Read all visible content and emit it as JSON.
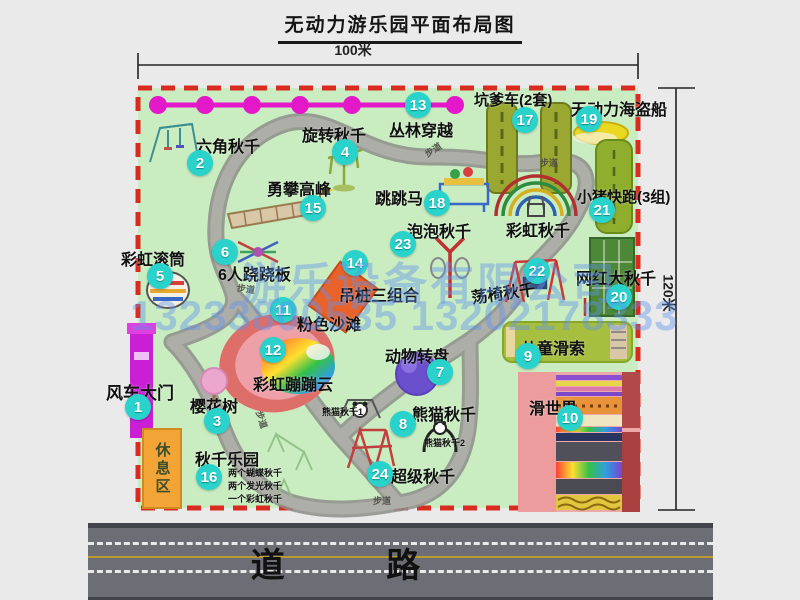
{
  "title": "无动力游乐园平面布局图",
  "dimensions": {
    "width_label": "100米",
    "height_label": "120米"
  },
  "road": {
    "label": "道 路"
  },
  "watermark": {
    "line1": "游乐设备有限公司",
    "line2": "13233800535 13202178333"
  },
  "park": {
    "rest_area_label": "休息区",
    "path_label": "步道",
    "extra_labels": {
      "rainbow_swing": "彩虹秋千",
      "panda_swing_1": "熊猫秋千1",
      "panda_swing_2": "熊猫秋千2"
    },
    "items": [
      {
        "num": "1",
        "label": "风车大门"
      },
      {
        "num": "2",
        "label": "六角秋千"
      },
      {
        "num": "3",
        "label": "樱花树"
      },
      {
        "num": "4",
        "label": "旋转秋千"
      },
      {
        "num": "5",
        "label": "彩虹滚筒"
      },
      {
        "num": "6",
        "label": "6人跷跷板"
      },
      {
        "num": "7",
        "label": "动物转盘"
      },
      {
        "num": "8",
        "label": "熊猫秋千"
      },
      {
        "num": "9",
        "label": "儿童滑索"
      },
      {
        "num": "10",
        "label": "滑世界"
      },
      {
        "num": "11",
        "label": "粉色沙滩"
      },
      {
        "num": "12",
        "label": "彩虹蹦蹦云"
      },
      {
        "num": "13",
        "label": "丛林穿越"
      },
      {
        "num": "14",
        "label": "吊桩三组合"
      },
      {
        "num": "15",
        "label": "勇攀高峰"
      },
      {
        "num": "16",
        "label": "秋千乐园",
        "sub": [
          "两个蝴蝶秋千",
          "两个发光秋千",
          "一个彩虹秋千"
        ]
      },
      {
        "num": "17",
        "label": "坑爹车(2套)"
      },
      {
        "num": "18",
        "label": "跳跳马"
      },
      {
        "num": "19",
        "label": "无动力海盗船"
      },
      {
        "num": "20",
        "label": "网红大秋千"
      },
      {
        "num": "21",
        "label": "小猪快跑(3组)"
      },
      {
        "num": "22",
        "label": "荡椅秋千"
      },
      {
        "num": "23",
        "label": "泡泡秋千"
      },
      {
        "num": "24",
        "label": "超级秋千"
      }
    ]
  },
  "colors": {
    "park_green": "#c9edc1",
    "boundary_red": "#d92b1f",
    "path_gray": "#a9a9a4",
    "marker_cyan": "#29d3cc",
    "zipline_magenta": "#e318c8",
    "gate_magenta": "#cb1fd6",
    "rest_orange": "#f2a437",
    "road_gray": "#6d6d75"
  }
}
